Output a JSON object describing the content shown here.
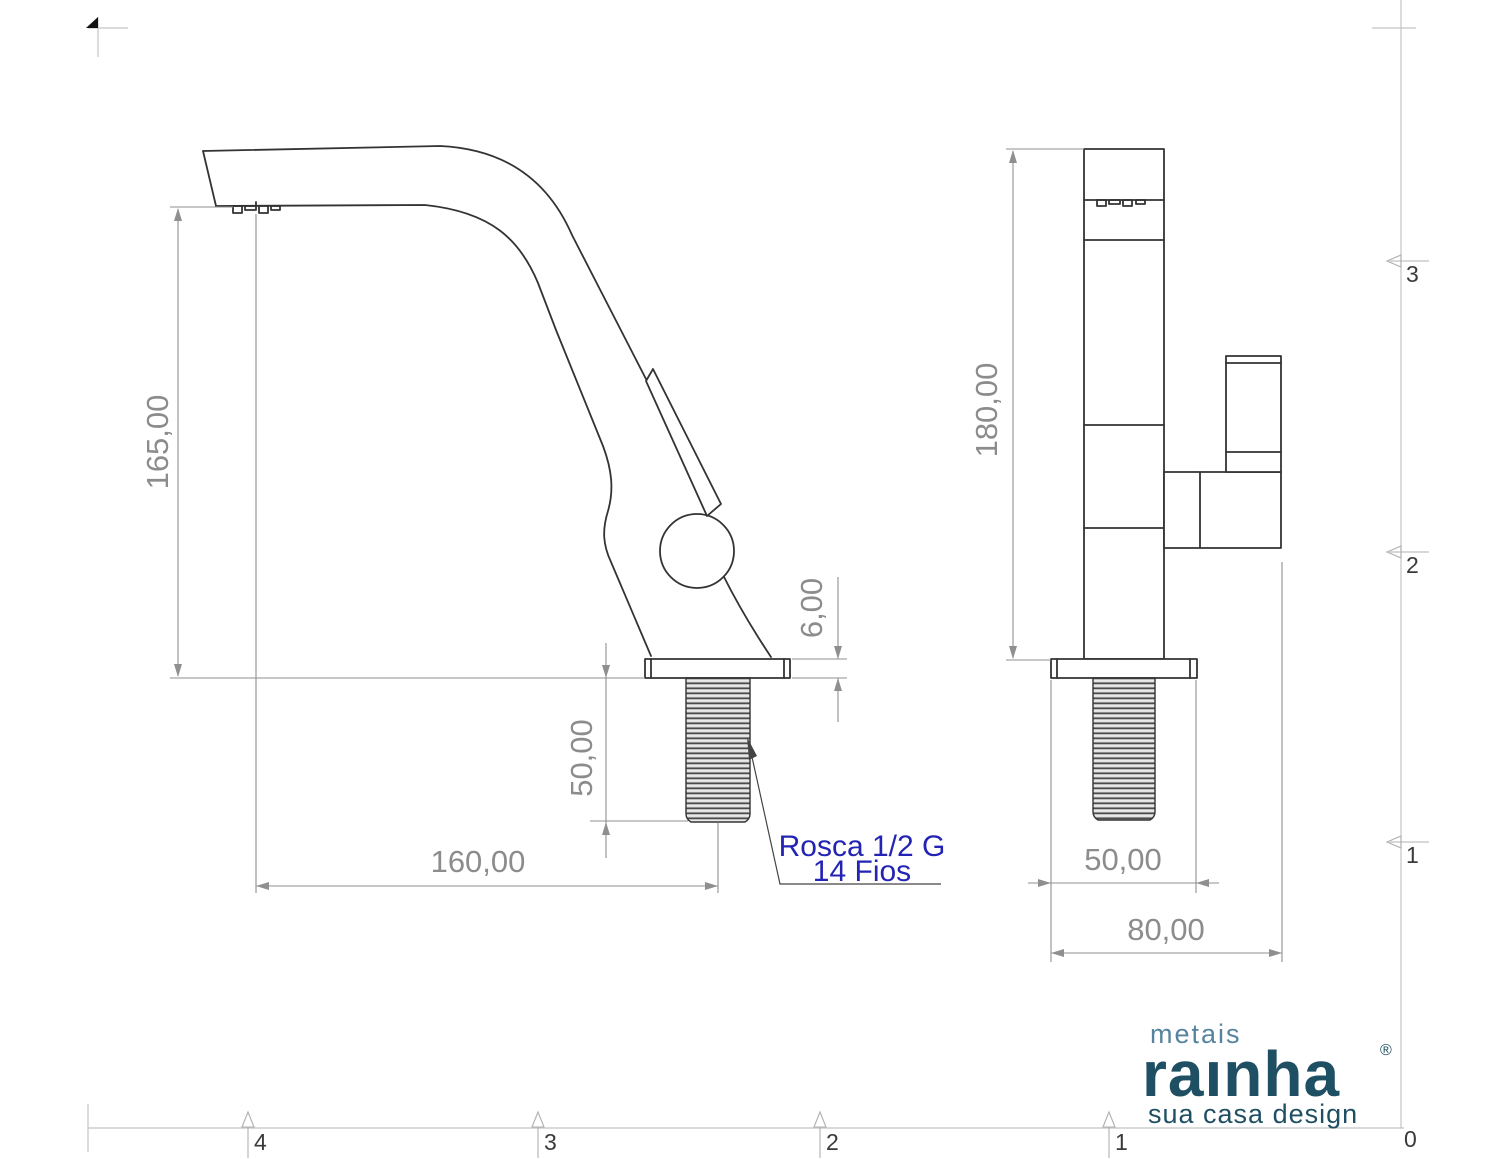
{
  "drawing_type": "faucet technical drawing, two orthographic views",
  "colors": {
    "object_line": "#333333",
    "dimension_gray": "#8c8c8c",
    "note_blue": "#2323b4",
    "brand_dark_teal": "#1f4f63",
    "brand_light_teal": "#5683a0",
    "frame_gray": "#c4c4c4"
  },
  "views": {
    "side_view": {
      "dimensions": {
        "height": "165,00",
        "reach": "160,00",
        "thread_length": "50,00",
        "flange_thickness": "6,00"
      },
      "note": {
        "line1": "Rosca 1/2 G",
        "line2": "14 Fios"
      }
    },
    "front_view": {
      "dimensions": {
        "height": "180,00",
        "thread_width": "50,00",
        "base_width": "80,00"
      }
    }
  },
  "frame": {
    "bottom_zones": [
      "4",
      "3",
      "2",
      "1"
    ],
    "right_zones": [
      "3",
      "2",
      "1"
    ],
    "origin_label": "0"
  },
  "logo": {
    "metais": "metais",
    "brand": "raınha",
    "registered": "®",
    "tagline": "sua casa design"
  }
}
